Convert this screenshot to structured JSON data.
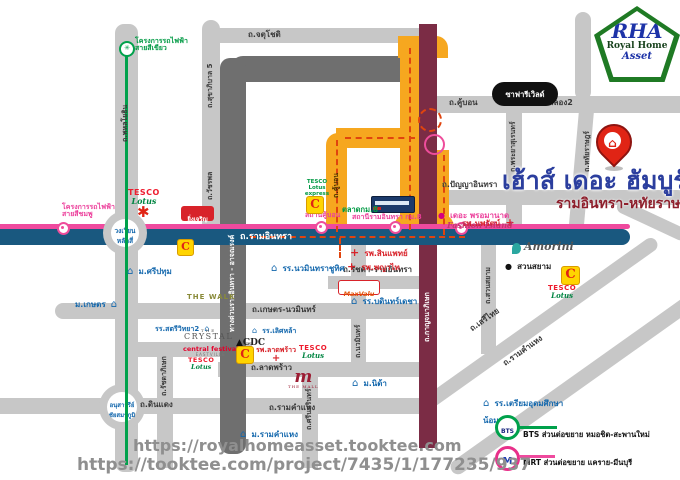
{
  "branding": {
    "rha": "RHA",
    "royal_home": "Royal Home",
    "asset": "Asset"
  },
  "project": {
    "title": "เฮ้าส์ เดอะ ฮัมบูร์ก",
    "subtitle": "รามอินทรา-หทัยราษฎร์"
  },
  "urls": {
    "line1": "https://royalhomeasset.tooktee.com",
    "line2": "https://tooktee.com/project/7435/1/177235/937"
  },
  "legend": {
    "bts": "BTS ส่วนต่อขยาย หมอชิต-สะพานใหม่",
    "mrt": "MRT ส่วนต่อขยาย แคราย-มีนบุรี",
    "bts_abbr": "BTS",
    "mrt_abbr": "M"
  },
  "roads": {
    "phahonyothin": "ถ.พหลโยธิน",
    "sukhaphiban5": "ถ.สุขาภิบาล 5",
    "watcharaphon": "ถ.วัชรพล",
    "chatuchot": "ถ.จตุโชติ",
    "expressway": "ทางด่วนรามอินทรา - อาจณรงค์",
    "khubon_v": "ถ.คู้บอน",
    "khubon_h": "ถ.คู้บอน",
    "liapkhlong2": "ถ.เลียบคลอง2",
    "phrayasuren": "ถ.พระยาสุเรนทร์",
    "hathairat": "ถ.หทัยราษฎร์",
    "panya_inthra": "ถ.ปัญญาอินทรา",
    "kanchanaphisek": "ถ.กาญจนาภิเษก",
    "ramintra": "ถ.รามอินทรา",
    "kaset_nawamin": "ถ.เกษตร-นวมินทร์",
    "ratchada_ramintra": "ถ.รัชดา-รามอินทรา",
    "nawamin": "ถ.นวมินทร์",
    "ladprao": "ถ.ลาดพร้าว",
    "ratchadaphisek": "ถ.รัชดาภิเษก",
    "dindaeng": "ถ.ดินแดง",
    "ramkhamhaeng_h": "ถ.รามคำแหง",
    "srinakarin": "ถ.ศรีนครินทร์",
    "suansiam": "ถ.สวนสยาม",
    "serithai": "ถ.เสรีไทย",
    "ramkhamhaeng_diag": "ถ.รามคำแหง"
  },
  "junctions": {
    "laksi": [
      "วงเวียน",
      "หลักสี่"
    ],
    "victory": [
      "อนุสาวรีย์",
      "ชัยสมรภูมิ"
    ]
  },
  "transit": {
    "green_project": [
      "โครงการรถไฟฟ้า",
      "สายสีเขียว"
    ],
    "pink_project": [
      "โครงการรถไฟฟ้า",
      "สายสีชมพู"
    ],
    "station_khubon": "สถานีคู้บอน",
    "station_ramintra_km8": "สถานีรามอินทรา กม.8"
  },
  "landmarks": {
    "safari_world": "ซาฟารีเวิลด์",
    "tesco": "TESCO",
    "lotus": "Lotus",
    "tesco_express": "TESCO Lotus express",
    "c_mark": "C",
    "yingcharoen": "ยิ่งเจริญ",
    "sripatum": "ม.ศรีปทุม",
    "kasetsart": "ม.เกษตร",
    "talad_km8": "ตลาดกม.8",
    "sinphaet": "รพ.สินแพทย์",
    "phyathai": "รพ.พญาไท",
    "nopparat": "รพ.นพรัตน์",
    "ladprao_hospital": "รพ.ลาดพร้าว",
    "promenade": "เดอะ พรอมานาด",
    "fashion_island": "Fashion Island",
    "maxvalu": "MaxValu",
    "bodindecha": "รร.บดินทร์เดชา",
    "nawamin_school": "รร.นวมินทราชูทิศ",
    "satriwit2": "รร.สตรีวิทยา2",
    "lertlah": "รร.เลิศหล้า",
    "triam_udom": [
      "รร.เตรียมอุดมศึกษา",
      "น้อมเกล้า"
    ],
    "amorini": "Amorini",
    "suan_siam_park": "สวนสยาม",
    "the_walk": "THE WALK",
    "the_crystal_the": "THE",
    "the_crystal": "CRYSTAL",
    "central_festival": "central festival",
    "eastville": "EASTVILLE",
    "cdc": "CDC",
    "the_mall_m": "m",
    "the_mall": "THE MALL",
    "nida": "ม.นิด้า",
    "ramkhamhaeng_u": "ม.รามคำแหง"
  },
  "colors": {
    "ramintra_blue": "#19587f",
    "pink_line": "#ef4a9e",
    "green_line": "#00a14b",
    "route_maroon": "#7b2c45",
    "highlight_orange": "#f6a71f"
  }
}
